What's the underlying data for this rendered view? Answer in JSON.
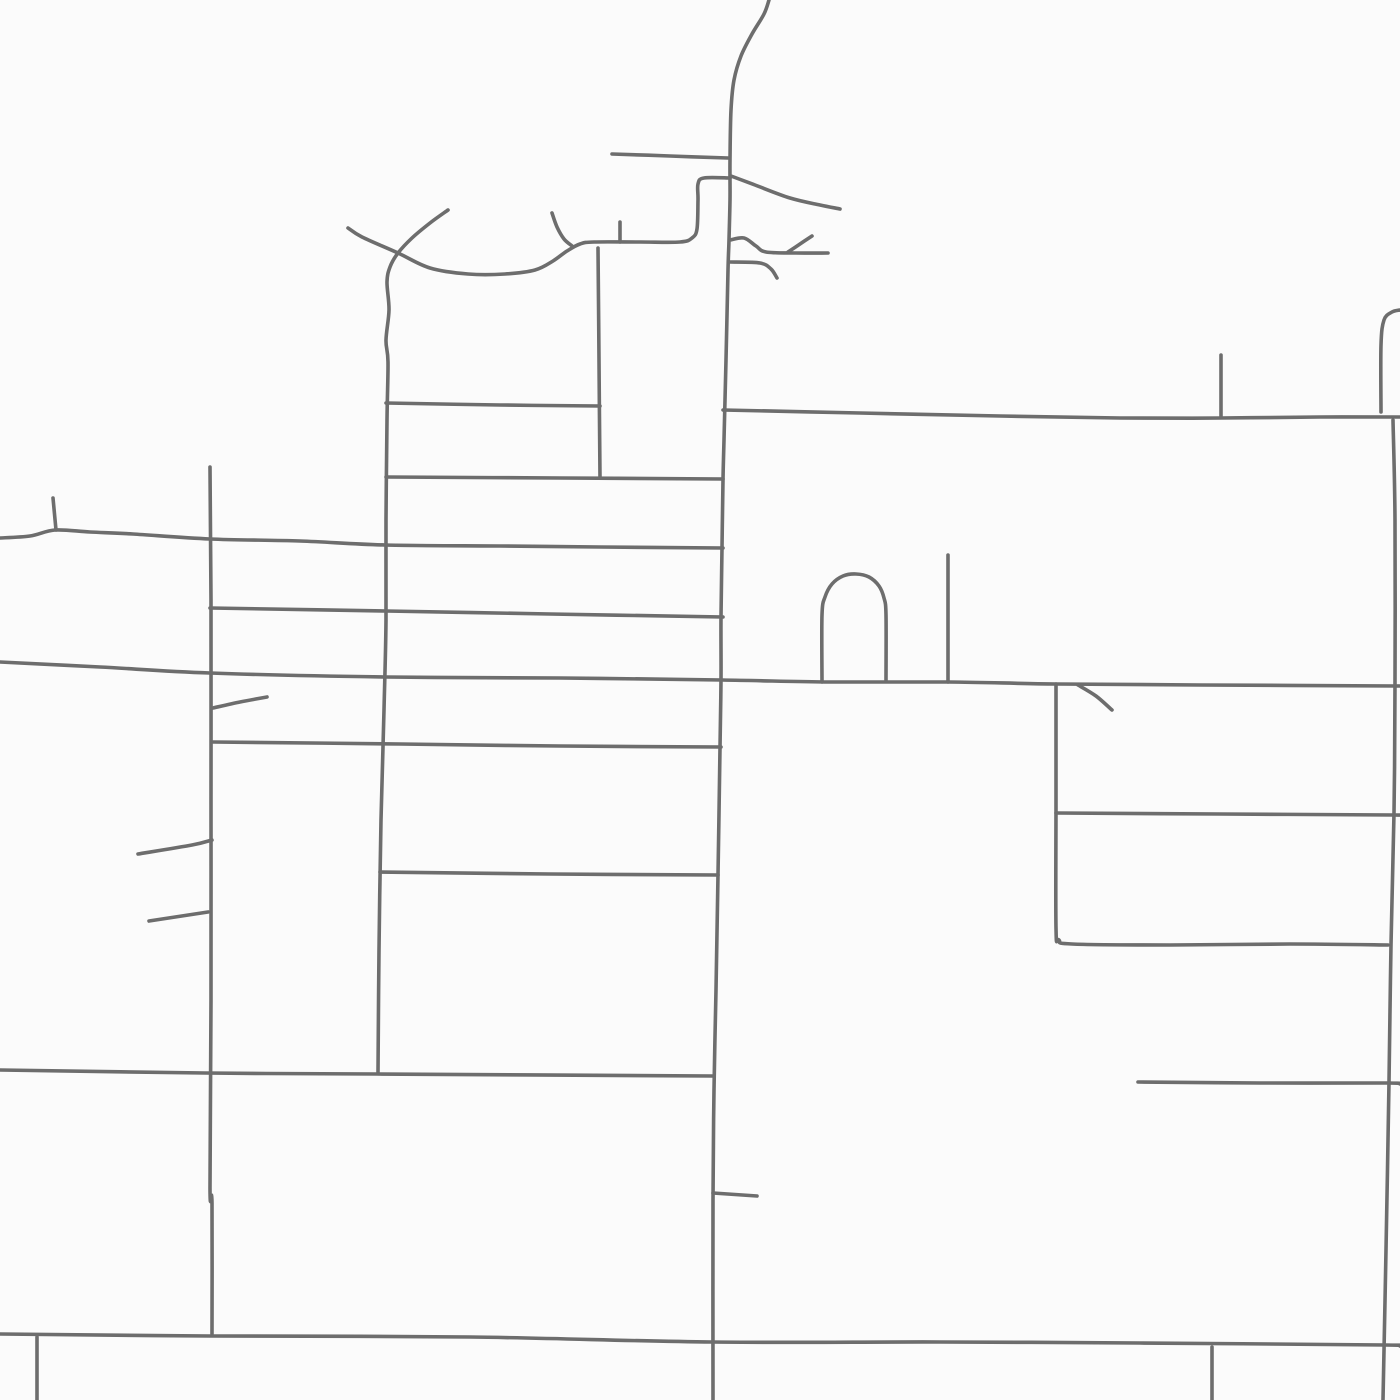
{
  "map": {
    "canvas": {
      "width": 1400,
      "height": 1400,
      "background": "#fbfbfb"
    },
    "style": {
      "road_color": "#6d6d6d",
      "road_width": 3.6
    },
    "roads": [
      {
        "id": "main-road-north-south",
        "points": [
          [
            769,
            0
          ],
          [
            764,
            14
          ],
          [
            752,
            34
          ],
          [
            741,
            56
          ],
          [
            734,
            80
          ],
          [
            731,
            110
          ],
          [
            730,
            160
          ],
          [
            730,
            200
          ],
          [
            729,
            240
          ],
          [
            728,
            270
          ],
          [
            726,
            360
          ],
          [
            724,
            440
          ],
          [
            723,
            480
          ],
          [
            722,
            548
          ],
          [
            721,
            617
          ],
          [
            721,
            680
          ],
          [
            720,
            748
          ],
          [
            718,
            875
          ],
          [
            716,
            990
          ],
          [
            714,
            1090
          ],
          [
            713,
            1200
          ],
          [
            713,
            1400
          ]
        ]
      },
      {
        "id": "dead-end-road-west",
        "points": [
          [
            612,
            154
          ],
          [
            670,
            156
          ],
          [
            728,
            158
          ]
        ]
      },
      {
        "id": "crescent-road",
        "points": [
          [
            348,
            228
          ],
          [
            362,
            237
          ],
          [
            398,
            253
          ],
          [
            430,
            268
          ],
          [
            468,
            274
          ],
          [
            505,
            274
          ],
          [
            535,
            270
          ],
          [
            553,
            261
          ],
          [
            567,
            251
          ],
          [
            580,
            244
          ],
          [
            594,
            242
          ],
          [
            640,
            242
          ],
          [
            680,
            242
          ],
          [
            692,
            238
          ],
          [
            697,
            229
          ],
          [
            698,
            200
          ],
          [
            698,
            184
          ],
          [
            704,
            178
          ],
          [
            730,
            178
          ]
        ]
      },
      {
        "id": "west-wavy-vertical-road",
        "points": [
          [
            448,
            210
          ],
          [
            430,
            223
          ],
          [
            412,
            238
          ],
          [
            398,
            253
          ],
          [
            390,
            267
          ],
          [
            387,
            282
          ],
          [
            389,
            310
          ],
          [
            386,
            340
          ],
          [
            388,
            362
          ],
          [
            387,
            420
          ],
          [
            386,
            520
          ],
          [
            386,
            620
          ],
          [
            384,
            710
          ],
          [
            381,
            820
          ],
          [
            379,
            950
          ],
          [
            378,
            1073
          ]
        ]
      },
      {
        "id": "small-branch-road",
        "points": [
          [
            552,
            213
          ],
          [
            557,
            227
          ],
          [
            564,
            239
          ],
          [
            572,
            246
          ]
        ]
      },
      {
        "id": "stub-road-620",
        "points": [
          [
            620,
            222
          ],
          [
            620,
            242
          ]
        ]
      },
      {
        "id": "vertical-road-600",
        "points": [
          [
            598,
            248
          ],
          [
            599,
            360
          ],
          [
            600,
            478
          ]
        ]
      },
      {
        "id": "curving-road-east",
        "points": [
          [
            731,
            176
          ],
          [
            755,
            185
          ],
          [
            790,
            198
          ],
          [
            820,
            205
          ],
          [
            840,
            209
          ]
        ]
      },
      {
        "id": "squiggle-road-north",
        "points": [
          [
            730,
            240
          ],
          [
            744,
            238
          ],
          [
            756,
            246
          ],
          [
            766,
            252
          ],
          [
            796,
            253
          ],
          [
            828,
            253
          ]
        ]
      },
      {
        "id": "squiggle-branch",
        "points": [
          [
            788,
            252
          ],
          [
            800,
            244
          ],
          [
            812,
            236
          ]
        ]
      },
      {
        "id": "squiggle-road-south",
        "points": [
          [
            730,
            262
          ],
          [
            760,
            263
          ],
          [
            771,
            269
          ],
          [
            777,
            278
          ]
        ]
      },
      {
        "id": "cross-street-403",
        "points": [
          [
            386,
            403
          ],
          [
            500,
            405
          ],
          [
            600,
            406
          ]
        ]
      },
      {
        "id": "cross-street-477",
        "points": [
          [
            386,
            477
          ],
          [
            560,
            478
          ],
          [
            723,
            479
          ]
        ]
      },
      {
        "id": "long-road-west-538",
        "points": [
          [
            0,
            538
          ],
          [
            30,
            536
          ],
          [
            55,
            530
          ],
          [
            90,
            532
          ],
          [
            133,
            534
          ],
          [
            210,
            539
          ],
          [
            300,
            541
          ],
          [
            386,
            545
          ],
          [
            500,
            546
          ],
          [
            600,
            547
          ],
          [
            723,
            548
          ]
        ]
      },
      {
        "id": "stub-road-53",
        "points": [
          [
            53,
            498
          ],
          [
            56,
            530
          ]
        ]
      },
      {
        "id": "vertical-road-210",
        "points": [
          [
            210,
            467
          ],
          [
            211,
            600
          ],
          [
            211,
            800
          ],
          [
            211,
            1000
          ],
          [
            210,
            1188
          ],
          [
            212,
            1203
          ],
          [
            212,
            1334
          ]
        ]
      },
      {
        "id": "cross-street-608",
        "points": [
          [
            210,
            608
          ],
          [
            386,
            611
          ],
          [
            550,
            614
          ],
          [
            723,
            617
          ]
        ]
      },
      {
        "id": "grand-avenue-675",
        "points": [
          [
            0,
            662
          ],
          [
            100,
            667
          ],
          [
            210,
            673
          ],
          [
            386,
            677
          ],
          [
            560,
            678
          ],
          [
            722,
            680
          ],
          [
            830,
            682
          ],
          [
            948,
            682
          ],
          [
            1056,
            684
          ],
          [
            1200,
            685
          ],
          [
            1400,
            686
          ]
        ]
      },
      {
        "id": "branch-diagonal-854",
        "points": [
          [
            138,
            854
          ],
          [
            192,
            845
          ],
          [
            212,
            840
          ]
        ]
      },
      {
        "id": "branch-diagonal-921",
        "points": [
          [
            149,
            921
          ],
          [
            208,
            912
          ]
        ]
      },
      {
        "id": "cross-street-742",
        "points": [
          [
            213,
            742
          ],
          [
            400,
            744
          ],
          [
            560,
            746
          ],
          [
            721,
            747
          ]
        ]
      },
      {
        "id": "branch-diagonal-708",
        "points": [
          [
            213,
            708
          ],
          [
            240,
            702
          ],
          [
            267,
            697
          ]
        ]
      },
      {
        "id": "cross-street-872",
        "points": [
          [
            380,
            872
          ],
          [
            550,
            874
          ],
          [
            718,
            875
          ]
        ]
      },
      {
        "id": "cross-street-1073",
        "points": [
          [
            0,
            1070
          ],
          [
            205,
            1073
          ],
          [
            377,
            1074
          ],
          [
            713,
            1076
          ]
        ]
      },
      {
        "id": "east-road-1082",
        "points": [
          [
            1138,
            1082
          ],
          [
            1260,
            1083
          ],
          [
            1387,
            1083
          ],
          [
            1400,
            1084
          ]
        ]
      },
      {
        "id": "boulevard-south-1334",
        "points": [
          [
            0,
            1334
          ],
          [
            210,
            1336
          ],
          [
            470,
            1337
          ],
          [
            712,
            1342
          ],
          [
            940,
            1342
          ],
          [
            1140,
            1343
          ],
          [
            1385,
            1345
          ],
          [
            1400,
            1346
          ]
        ]
      },
      {
        "id": "stub-road-37",
        "points": [
          [
            37,
            1337
          ],
          [
            37,
            1400
          ]
        ]
      },
      {
        "id": "stub-road-757",
        "points": [
          [
            713,
            1193
          ],
          [
            757,
            1196
          ]
        ]
      },
      {
        "id": "vertical-road-1212",
        "points": [
          [
            1212,
            1347
          ],
          [
            1212,
            1400
          ]
        ]
      },
      {
        "id": "arch-road",
        "points": [
          [
            822,
            682
          ],
          [
            822,
            615
          ],
          [
            825,
            597
          ],
          [
            832,
            584
          ],
          [
            843,
            576
          ],
          [
            856,
            574
          ],
          [
            869,
            577
          ],
          [
            879,
            586
          ],
          [
            884,
            598
          ],
          [
            886,
            615
          ],
          [
            886,
            680
          ]
        ]
      },
      {
        "id": "vertical-road-948",
        "points": [
          [
            948,
            555
          ],
          [
            948,
            682
          ]
        ]
      },
      {
        "id": "l-road-1056",
        "points": [
          [
            1056,
            684
          ],
          [
            1056,
            800
          ],
          [
            1056,
            928
          ],
          [
            1059,
            940
          ],
          [
            1072,
            944
          ],
          [
            1170,
            945
          ],
          [
            1290,
            944
          ],
          [
            1388,
            945
          ]
        ]
      },
      {
        "id": "east-road-813",
        "points": [
          [
            1056,
            813
          ],
          [
            1220,
            814
          ],
          [
            1394,
            815
          ],
          [
            1400,
            815
          ]
        ]
      },
      {
        "id": "branch-diagonal-685",
        "points": [
          [
            1078,
            685
          ],
          [
            1096,
            696
          ],
          [
            1112,
            710
          ]
        ]
      },
      {
        "id": "right-road-upper",
        "points": [
          [
            1400,
            310
          ],
          [
            1392,
            312
          ],
          [
            1384,
            320
          ],
          [
            1381,
            345
          ],
          [
            1381,
            412
          ]
        ]
      },
      {
        "id": "right-road-lower",
        "points": [
          [
            1393,
            420
          ],
          [
            1395,
            520
          ],
          [
            1395,
            684
          ],
          [
            1394,
            813
          ],
          [
            1391,
            945
          ],
          [
            1389,
            1082
          ],
          [
            1386,
            1250
          ],
          [
            1383,
            1400
          ]
        ]
      },
      {
        "id": "east-west-road-413",
        "points": [
          [
            723,
            410
          ],
          [
            860,
            413
          ],
          [
            1000,
            416
          ],
          [
            1120,
            418
          ],
          [
            1221,
            418
          ],
          [
            1320,
            417
          ],
          [
            1400,
            417
          ]
        ]
      },
      {
        "id": "stub-road-1221",
        "points": [
          [
            1221,
            355
          ],
          [
            1221,
            417
          ]
        ]
      }
    ]
  }
}
